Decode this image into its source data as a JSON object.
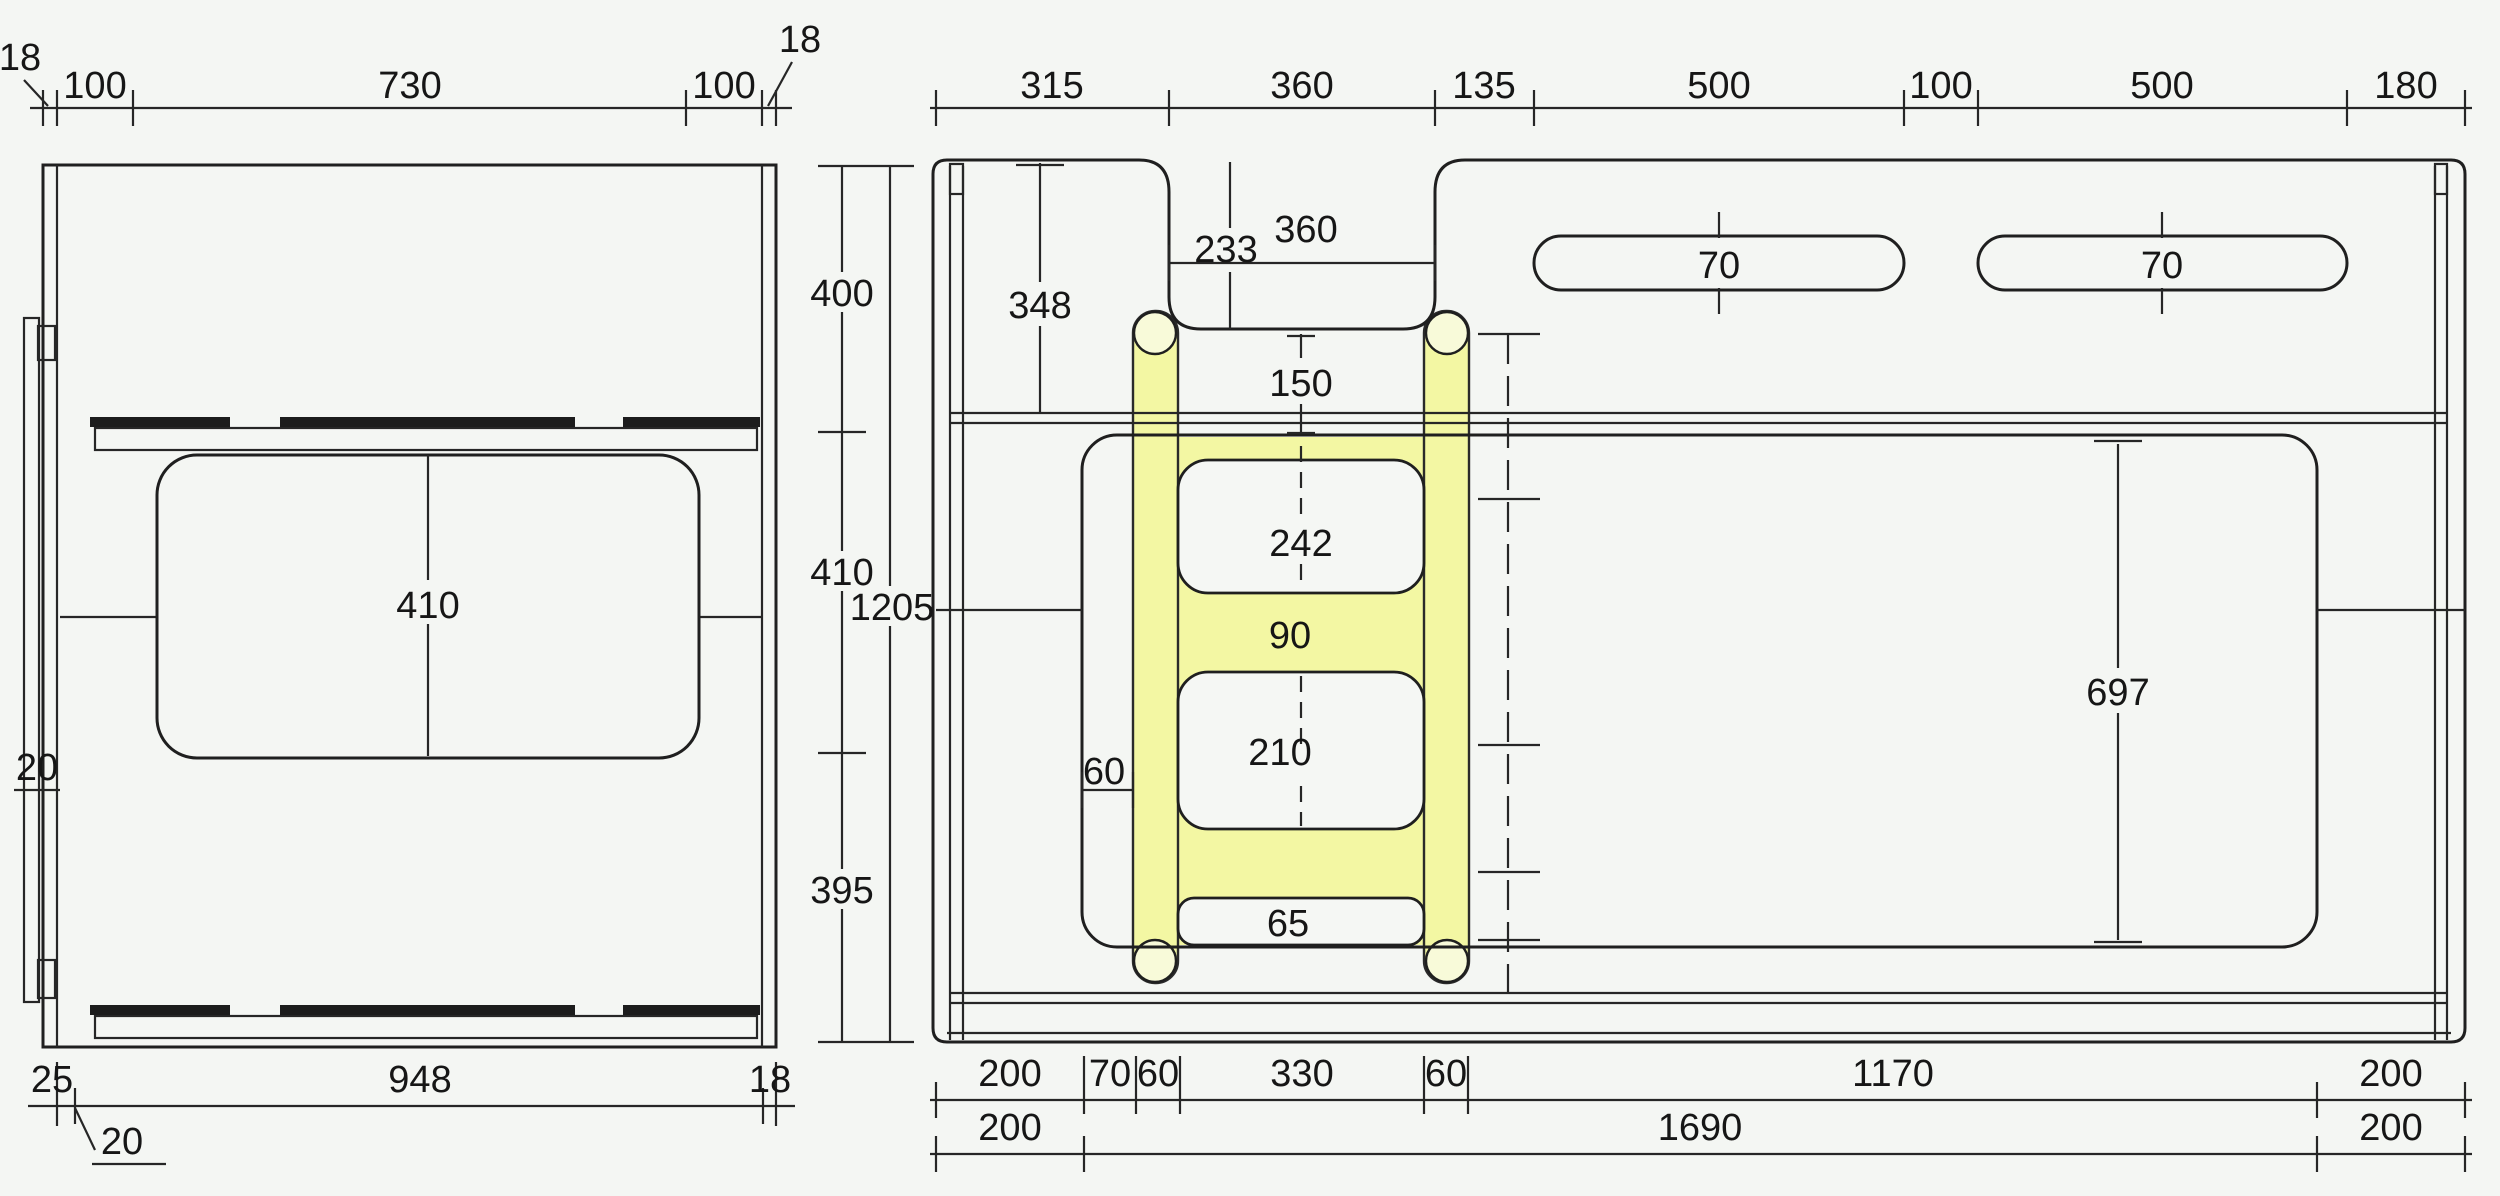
{
  "meta": {
    "kind": "technical-drawing",
    "subject": "Dimensioned CAD drawing of two furniture panels (bunk-bed side panels) with a yellow-highlighted ladder part",
    "units": "mm",
    "background_color": "#f4f6f3",
    "line_color": "#1f1f1f",
    "highlight_color": "#f3f7a3"
  },
  "views": {
    "left_panel": {
      "top_chain": [
        "18",
        "100",
        "730",
        "100",
        "18"
      ],
      "bottom_chain": [
        "25",
        "948",
        "18"
      ],
      "opening_height": "410",
      "plank_thickness": "20",
      "bottom_leader": "20"
    },
    "middle_heights": [
      "400",
      "410",
      "395"
    ],
    "overall_height": "1205",
    "right_panel": {
      "top_chain": [
        "315",
        "360",
        "135",
        "500",
        "100",
        "500",
        "180"
      ],
      "bottom_chain_row1": [
        "200",
        "70",
        "60",
        "330",
        "60",
        "1170",
        "200"
      ],
      "bottom_chain_row2": [
        "200",
        "1690",
        "200"
      ],
      "notch": {
        "width": "360",
        "depth_line": "233",
        "to_rail": "348",
        "below_notch": "150"
      },
      "hand_slots": [
        "70",
        "70"
      ],
      "ladder": {
        "upper_opening": "242",
        "rung": "90",
        "stile": "60",
        "lower_opening": "210",
        "foot_opening": "65"
      },
      "large_opening_height": "697"
    }
  },
  "labels": [
    {
      "id": "lv-18-left",
      "value": "18",
      "x": 20,
      "y": 70,
      "anchor": "middle"
    },
    {
      "id": "lv-100-left",
      "value": "100",
      "x": 95,
      "y": 98,
      "anchor": "middle"
    },
    {
      "id": "lv-730",
      "value": "730",
      "x": 410,
      "y": 98,
      "anchor": "middle"
    },
    {
      "id": "lv-100-right",
      "value": "100",
      "x": 724,
      "y": 98,
      "anchor": "middle"
    },
    {
      "id": "lv-18-right",
      "value": "18",
      "x": 800,
      "y": 52,
      "anchor": "middle"
    },
    {
      "id": "lv-410",
      "value": "410",
      "x": 428,
      "y": 618,
      "anchor": "middle"
    },
    {
      "id": "lv-20-mid",
      "value": "20",
      "x": 37,
      "y": 780,
      "anchor": "middle"
    },
    {
      "id": "lv-25",
      "value": "25",
      "x": 52,
      "y": 1092,
      "anchor": "middle"
    },
    {
      "id": "lv-948",
      "value": "948",
      "x": 420,
      "y": 1092,
      "anchor": "middle"
    },
    {
      "id": "lv-18-bottom",
      "value": "18",
      "x": 770,
      "y": 1092,
      "anchor": "middle"
    },
    {
      "id": "lv-20-bottom",
      "value": "20",
      "x": 122,
      "y": 1154,
      "anchor": "middle"
    },
    {
      "id": "mid-400",
      "value": "400",
      "x": 842,
      "y": 306,
      "anchor": "middle"
    },
    {
      "id": "mid-410",
      "value": "410",
      "x": 842,
      "y": 585,
      "anchor": "middle"
    },
    {
      "id": "mid-1205",
      "value": "1205",
      "x": 892,
      "y": 620,
      "anchor": "middle"
    },
    {
      "id": "mid-395",
      "value": "395",
      "x": 842,
      "y": 903,
      "anchor": "middle"
    },
    {
      "id": "rv-315",
      "value": "315",
      "x": 1052,
      "y": 98,
      "anchor": "middle"
    },
    {
      "id": "rv-360-top",
      "value": "360",
      "x": 1302,
      "y": 98,
      "anchor": "middle"
    },
    {
      "id": "rv-135",
      "value": "135",
      "x": 1484,
      "y": 98,
      "anchor": "middle"
    },
    {
      "id": "rv-500-a",
      "value": "500",
      "x": 1719,
      "y": 98,
      "anchor": "middle"
    },
    {
      "id": "rv-100",
      "value": "100",
      "x": 1941,
      "y": 98,
      "anchor": "middle"
    },
    {
      "id": "rv-500-b",
      "value": "500",
      "x": 2162,
      "y": 98,
      "anchor": "middle"
    },
    {
      "id": "rv-180",
      "value": "180",
      "x": 2406,
      "y": 98,
      "anchor": "middle"
    },
    {
      "id": "rv-348",
      "value": "348",
      "x": 1040,
      "y": 318,
      "anchor": "middle"
    },
    {
      "id": "rv-233",
      "value": "233",
      "x": 1226,
      "y": 262,
      "anchor": "middle"
    },
    {
      "id": "rv-360-notch",
      "value": "360",
      "x": 1306,
      "y": 242,
      "anchor": "middle"
    },
    {
      "id": "rv-70-slot1",
      "value": "70",
      "x": 1719,
      "y": 278,
      "anchor": "middle"
    },
    {
      "id": "rv-70-slot2",
      "value": "70",
      "x": 2162,
      "y": 278,
      "anchor": "middle"
    },
    {
      "id": "rv-150",
      "value": "150",
      "x": 1301,
      "y": 396,
      "anchor": "middle"
    },
    {
      "id": "rv-242",
      "value": "242",
      "x": 1301,
      "y": 556,
      "anchor": "middle"
    },
    {
      "id": "rv-90",
      "value": "90",
      "x": 1290,
      "y": 648,
      "anchor": "middle"
    },
    {
      "id": "rv-60-stile",
      "value": "60",
      "x": 1104,
      "y": 784,
      "anchor": "middle"
    },
    {
      "id": "rv-210",
      "value": "210",
      "x": 1280,
      "y": 765,
      "anchor": "middle"
    },
    {
      "id": "rv-65",
      "value": "65",
      "x": 1288,
      "y": 936,
      "anchor": "middle"
    },
    {
      "id": "rv-697",
      "value": "697",
      "x": 2118,
      "y": 705,
      "anchor": "middle"
    },
    {
      "id": "rb1-200-l",
      "value": "200",
      "x": 1010,
      "y": 1086,
      "anchor": "middle"
    },
    {
      "id": "rb1-70",
      "value": "70",
      "x": 1110,
      "y": 1086,
      "anchor": "middle"
    },
    {
      "id": "rb1-60-a",
      "value": "60",
      "x": 1158,
      "y": 1086,
      "anchor": "middle"
    },
    {
      "id": "rb1-330",
      "value": "330",
      "x": 1302,
      "y": 1086,
      "anchor": "middle"
    },
    {
      "id": "rb1-60-b",
      "value": "60",
      "x": 1446,
      "y": 1086,
      "anchor": "middle"
    },
    {
      "id": "rb1-1170",
      "value": "1170",
      "x": 1893,
      "y": 1086,
      "anchor": "middle"
    },
    {
      "id": "rb1-200-r",
      "value": "200",
      "x": 2391,
      "y": 1086,
      "anchor": "middle"
    },
    {
      "id": "rb2-200-l",
      "value": "200",
      "x": 1010,
      "y": 1140,
      "anchor": "middle"
    },
    {
      "id": "rb2-1690",
      "value": "1690",
      "x": 1700,
      "y": 1140,
      "anchor": "middle"
    },
    {
      "id": "rb2-200-r",
      "value": "200",
      "x": 2391,
      "y": 1140,
      "anchor": "middle"
    }
  ]
}
